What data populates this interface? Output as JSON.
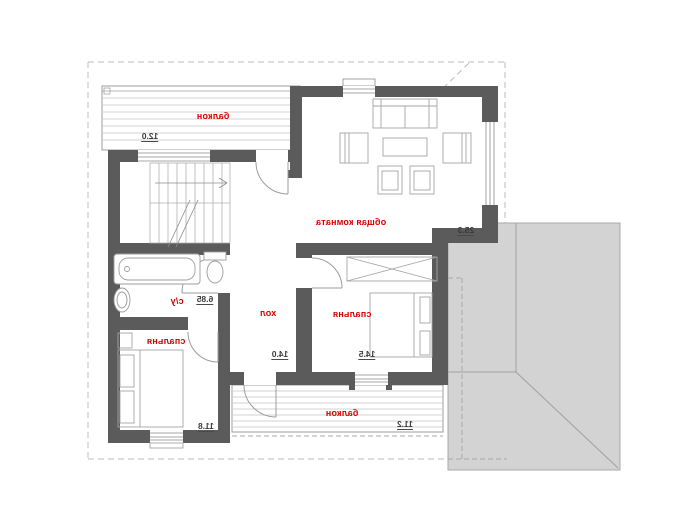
{
  "plan": {
    "title": "second floor plan (mirrored)",
    "rooms": {
      "balcony_top": {
        "label": "балкон",
        "area": "12.0"
      },
      "living": {
        "label": "общая комната",
        "area": "25.3"
      },
      "wc": {
        "label": "с/у",
        "area": "6.85"
      },
      "hall": {
        "label": "хол",
        "area": "14.0"
      },
      "bedroom_right": {
        "label": "спальня",
        "area": "14.5"
      },
      "bedroom_bottom": {
        "label": "спальня",
        "area": "11.8"
      },
      "balcony_bottom": {
        "label": "балкон",
        "area": "11.2"
      }
    },
    "colors": {
      "wall": "#5b5b5b",
      "room_label": "#d40000",
      "area_text": "#3b3b3b",
      "roof_fill": "#d3d3d3",
      "roof_line": "#a9a9a9",
      "thin_line": "#9c9c9c",
      "deck_line": "#c4c4c4",
      "dash_line": "#bcbcbc"
    }
  }
}
